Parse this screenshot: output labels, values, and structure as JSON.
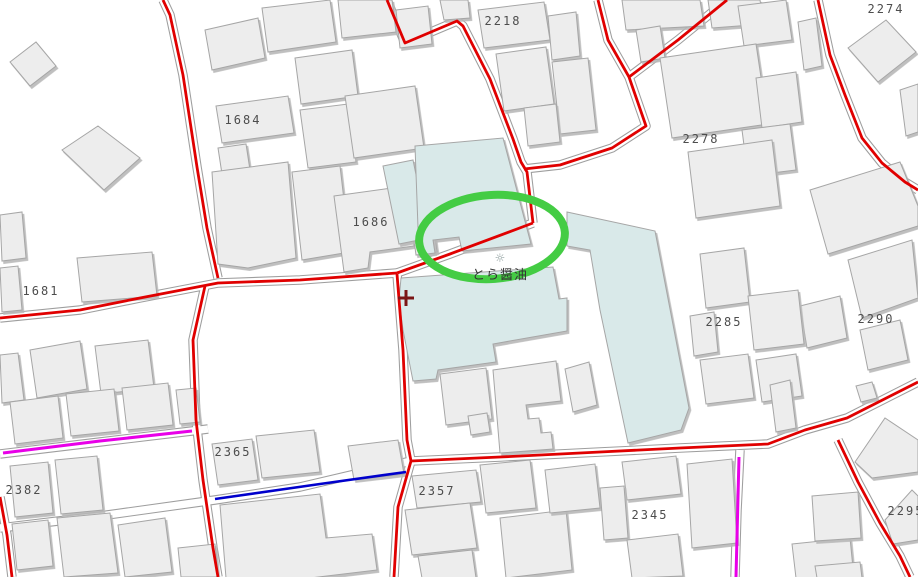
{
  "map": {
    "width": 918,
    "height": 577,
    "colors": {
      "background": "#ffffff",
      "building_fill": "#ededed",
      "building_stroke": "#a6a6a6",
      "building_shadow": "#b8b8b8",
      "highlight_building_fill": "#d9e9e9",
      "road_casing": "#9e9e9e",
      "road_fill": "#ffffff",
      "road_red": "#e00000",
      "line_magenta": "#e800e8",
      "line_blue": "#0000cc",
      "annotation_green": "#44cc44",
      "cross_marker": "#7a1515",
      "label_color": "#4d4d4d"
    },
    "poi": {
      "label": "とら醤油",
      "icon_glyph": "☼",
      "x": 500,
      "y": 268
    },
    "parcel_labels": [
      {
        "text": "2218",
        "x": 503,
        "y": 21
      },
      {
        "text": "2274",
        "x": 886,
        "y": 9
      },
      {
        "text": "2278",
        "x": 701,
        "y": 139
      },
      {
        "text": "1684",
        "x": 243,
        "y": 120
      },
      {
        "text": "1686",
        "x": 371,
        "y": 222
      },
      {
        "text": "1681",
        "x": 41,
        "y": 291
      },
      {
        "text": "2285",
        "x": 724,
        "y": 322
      },
      {
        "text": "2290",
        "x": 876,
        "y": 319
      },
      {
        "text": "2365",
        "x": 233,
        "y": 452
      },
      {
        "text": "2382",
        "x": 24,
        "y": 490
      },
      {
        "text": "2357",
        "x": 437,
        "y": 491
      },
      {
        "text": "2345",
        "x": 650,
        "y": 515
      },
      {
        "text": "2295",
        "x": 906,
        "y": 511
      }
    ],
    "annotations": {
      "ellipse": {
        "cx": 492,
        "cy": 237,
        "rx": 73,
        "ry": 42,
        "rotation": -4,
        "stroke_width": 8
      },
      "cross": {
        "x": 406,
        "y": 298,
        "arm": 8,
        "stroke_width": 3
      }
    },
    "roads": {
      "red": [
        "163,0 170,15 183,75 197,167 207,228 218,278",
        "0,318 80,310 140,298 218,283 300,280 397,273",
        "397,273 450,254 533,223",
        "533,223 527,172 521,162 513,139 490,79 463,26 457,21 405,43 387,0",
        "524,169 560,165 612,148 646,126 629,77 608,40 598,0",
        "629,77 678,40 727,0",
        "397,274 403,350 407,440 411,461 398,507 394,577",
        "411,461 500,457 600,452 680,448 768,444 805,430 847,418 918,382",
        "838,440 858,482 880,523 900,556 910,577",
        "818,0 830,55 845,95 862,138 882,163 905,182 918,190",
        "205,286 193,340 196,420 203,480 213,548 218,577",
        "0,497 7,535 12,577"
      ],
      "white_extra": [
        "411,461 300,487 215,500 100,516 0,528",
        "0,454 100,442 192,431 208,429",
        "740,450 737,510 735,577"
      ],
      "blue": [
        "215,499 320,484 406,472"
      ],
      "magenta": [
        "3,453 100,441 192,431",
        "739,457 736,577"
      ]
    },
    "buildings": {
      "teal": [
        "383,166 413,160 429,238 399,244",
        "415,146 503,138 531,244 462,251 459,237 433,240 435,253 419,255",
        "401,278 553,267 559,299 567,298 567,331 493,344 496,362 438,370 436,379 413,381 403,330 399,300",
        "567,212 655,231 689,408 681,430 628,443 600,310 590,250 567,246"
      ],
      "gray": [
        "10,62 36,42 56,66 30,86",
        "62,150 98,126 140,158 104,190",
        "97,268 124,260 131,284 104,292",
        "77,258 152,252 157,296 82,302",
        "30,350 80,341 87,389 37,398",
        "95,346 148,340 154,388 101,394",
        "0,355 18,353 24,400 2,403",
        "10,402 58,396 63,438 15,444",
        "66,394 114,389 119,431 71,436",
        "122,388 168,383 173,425 127,430",
        "176,390 196,388 200,422 180,424",
        "10,466 48,462 53,513 15,517",
        "55,460 97,456 103,510 61,514",
        "12,524 48,520 53,566 17,570",
        "57,518 110,513 118,573 64,577",
        "118,525 165,518 172,572 125,577",
        "178,548 215,544 218,577 181,577",
        "205,30 258,18 265,58 212,70",
        "262,8 330,0 336,42 268,52",
        "338,0 392,0 396,32 342,38",
        "396,10 428,6 432,44 400,48",
        "216,106 288,96 294,133 222,143",
        "295,58 352,50 358,96 301,104",
        "300,110 348,104 356,162 308,168",
        "218,148 246,144 250,170 222,174",
        "212,172 288,162 296,258 248,268 218,264",
        "292,172 340,166 350,252 302,260",
        "345,96 415,86 424,148 354,158",
        "334,196 406,186 414,246 370,252 368,268 344,272",
        "412,226 433,223 437,252 416,255",
        "440,0 468,0 470,18 444,20",
        "478,10 544,2 550,40 484,48",
        "496,54 546,47 554,104 504,111",
        "548,16 576,12 580,56 552,60",
        "552,62 588,58 596,130 560,134",
        "524,108 556,104 560,142 528,146",
        "622,0 700,0 704,26 626,30",
        "708,0 760,0 764,24 712,28",
        "738,6 786,0 792,40 744,46",
        "798,22 816,18 822,66 804,70",
        "636,30 660,26 665,58 641,62",
        "660,58 756,44 768,124 672,138",
        "756,78 796,72 802,122 762,128",
        "742,130 790,124 796,170 748,176",
        "848,48 886,20 916,52 878,82",
        "900,90 918,84 918,132 906,136",
        "810,190 900,162 918,206 918,226 828,254",
        "848,260 912,240 918,298 862,318",
        "800,306 840,296 847,338 807,348",
        "860,330 900,320 908,360 868,370",
        "688,152 772,140 780,206 696,218",
        "700,254 744,248 750,302 706,308",
        "748,296 798,290 804,344 754,350",
        "690,316 714,312 718,352 694,356",
        "700,360 748,354 754,398 706,404",
        "756,360 796,354 802,396 762,402",
        "770,385 790,380 796,428 776,432",
        "856,386 872,382 877,398 861,402",
        "0,215 22,212 26,258 2,261",
        "0,268 18,266 22,310 2,312",
        "212,444 252,439 258,480 218,485",
        "256,436 314,430 320,472 262,478",
        "348,446 398,440 404,474 354,480",
        "412,476 476,470 481,502 417,508",
        "480,465 530,460 536,508 486,513",
        "220,505 320,494 326,538 372,534 377,570 310,578 226,578",
        "405,510 470,503 477,548 412,555",
        "418,556 472,550 476,578 422,578",
        "500,518 566,510 572,570 506,578",
        "545,470 595,464 600,508 550,513",
        "440,374 486,368 492,419 446,425",
        "468,416 487,413 490,432 471,435",
        "493,370 556,361 561,401 526,405 528,419 539,418 541,433 551,432 553,449 500,453",
        "565,369 589,362 597,405 573,412",
        "622,462 676,456 681,494 627,500",
        "600,488 624,486 628,538 604,540",
        "627,540 678,534 683,576 632,578",
        "687,464 732,459 737,543 692,548",
        "792,544 850,538 854,578 796,578",
        "855,462 885,418 918,440 918,472 872,478",
        "812,496 858,492 861,538 815,541",
        "885,520 912,490 918,496 918,540 893,544",
        "815,566 860,562 862,578 817,578"
      ]
    }
  }
}
